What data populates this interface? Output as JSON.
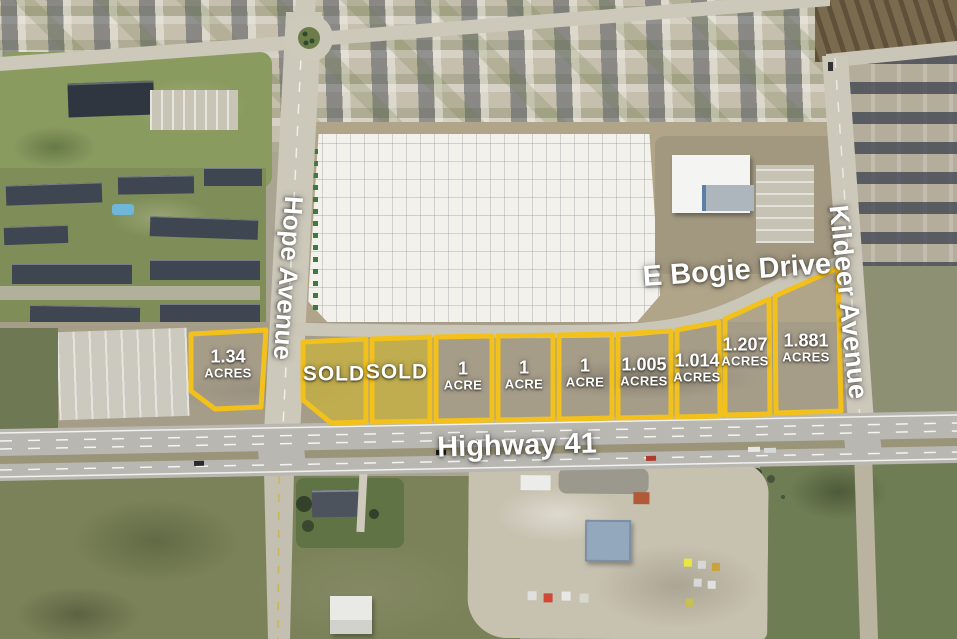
{
  "map": {
    "streets": {
      "hope_avenue": "Hope Avenue",
      "e_bogie_drive": "E Bogie Drive",
      "kildeer_avenue": "Kildeer Avenue",
      "highway_41": "Highway 41"
    },
    "parcels": [
      {
        "lot": "lot-1",
        "line1": "1.34",
        "line2": "ACRES",
        "status": "available"
      },
      {
        "lot": "lot-2",
        "line1": "SOLD",
        "line2": "",
        "status": "sold"
      },
      {
        "lot": "lot-3",
        "line1": "SOLD",
        "line2": "",
        "status": "sold"
      },
      {
        "lot": "lot-4",
        "line1": "1",
        "line2": "ACRE",
        "status": "available"
      },
      {
        "lot": "lot-5",
        "line1": "1",
        "line2": "ACRE",
        "status": "available"
      },
      {
        "lot": "lot-6",
        "line1": "1",
        "line2": "ACRE",
        "status": "available"
      },
      {
        "lot": "lot-7",
        "line1": "1.005",
        "line2": "ACRES",
        "status": "available"
      },
      {
        "lot": "lot-8",
        "line1": "1.014",
        "line2": "ACRES",
        "status": "available"
      },
      {
        "lot": "lot-9",
        "line1": "1.207",
        "line2": "ACRES",
        "status": "available"
      },
      {
        "lot": "lot-10",
        "line1": "1.881",
        "line2": "ACRES",
        "status": "available"
      }
    ],
    "colors": {
      "parcel_outline": "#F3C11C",
      "sold_fill": "rgba(208,184,40,0.6)",
      "label_text": "#FFFFFF"
    }
  }
}
